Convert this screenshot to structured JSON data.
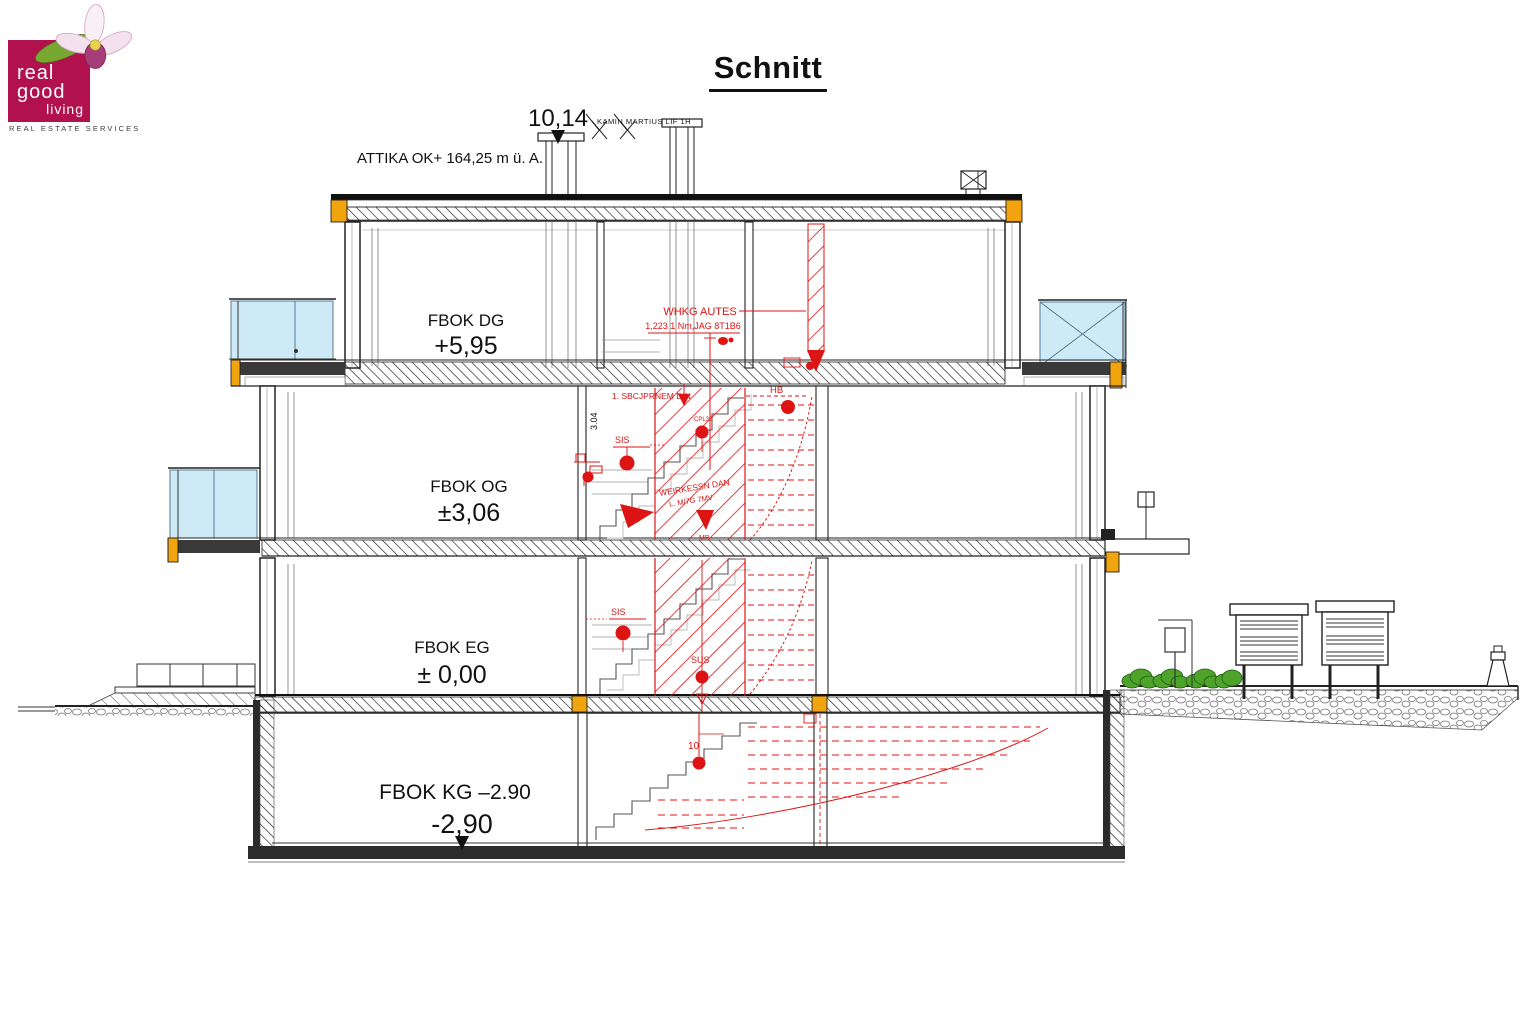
{
  "logo": {
    "word1": "real",
    "word2": "good",
    "word3": "living",
    "tagline": "REAL ESTATE SERVICES"
  },
  "title": "Schnitt",
  "drawing": {
    "attika_label": "ATTIKA OK+ 164,25 m ü. A.",
    "top_dimension": "10,14",
    "top_small_label": "KAMIN MARTIUS LIF 1H",
    "side_dimension": "3.04",
    "levels": [
      {
        "id": "dg",
        "label": "FBOK DG",
        "value": "+5,95"
      },
      {
        "id": "og",
        "label": "FBOK OG",
        "value": "±3,06"
      },
      {
        "id": "eg",
        "label": "FBOK EG",
        "value": "± 0,00"
      },
      {
        "id": "kg",
        "label": "FBOK KG –2.90",
        "value": "-2,90"
      }
    ],
    "red_annotations": {
      "whkg_line1": "WHKG AUTES",
      "whkg_line2": "1,223 1 Nm,JAG 8T1B6",
      "og_note": "1. SBCJPRNEM DIN",
      "hb": "HB",
      "sis_og": "SIS",
      "cpl": "CPL30",
      "kessel_line1": "WEIRKESSN DAN",
      "kessel_line2": "L. M/7G 7MV",
      "mb": "MB",
      "sis_eg": "SIS",
      "sus": "SUS",
      "kg_num": "10"
    },
    "colors": {
      "red": "#dd1414",
      "yellow": "#f1a40e",
      "glass": "#cdeaf6",
      "dark": "#3a3a3a",
      "green": "#4ea32a",
      "logo": "#b1114d"
    }
  }
}
